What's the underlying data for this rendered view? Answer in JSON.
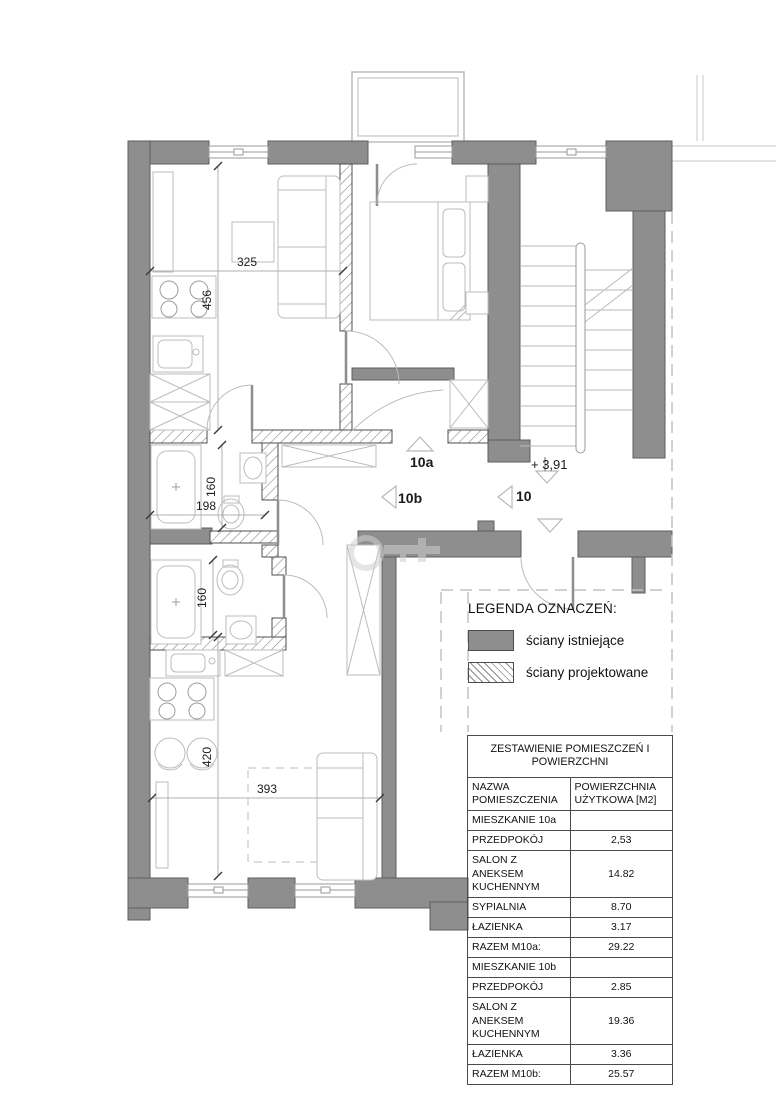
{
  "plan": {
    "dims": {
      "salon_10a_width": "325",
      "salon_10a_height": "456",
      "bath_10a_width": "198",
      "bath_10a_height": "160",
      "bath_10b_height": "160",
      "salon_10b_height": "420",
      "salon_10b_width": "393"
    },
    "markers": {
      "apt_10a": "10a",
      "apt_10b": "10b",
      "entrance_10": "10",
      "level": "+ 3,91"
    }
  },
  "legend": {
    "title": "LEGENDA OZNACZEŃ:",
    "items": [
      {
        "label": "ściany istniejące",
        "swatch": "solid"
      },
      {
        "label": "ściany projektowane",
        "swatch": "hatched"
      }
    ]
  },
  "table": {
    "title": "ZESTAWIENIE POMIESZCZEŃ I POWIERZCHNI",
    "columns": [
      "NAZWA POMIESZCZENIA",
      "POWIERZCHNIA UŻYTKOWA [M2]"
    ],
    "rows": [
      {
        "name": "MIESZKANIE 10a",
        "area": ""
      },
      {
        "name": "PRZEDPOKÓJ",
        "area": "2,53"
      },
      {
        "name": "SALON Z ANEKSEM KUCHENNYM",
        "area": "14.82"
      },
      {
        "name": "SYPIALNIA",
        "area": "8.70"
      },
      {
        "name": "ŁAZIENKA",
        "area": "3.17"
      },
      {
        "name": "RAZEM M10a:",
        "area": "29.22"
      },
      {
        "name": "MIESZKANIE 10b",
        "area": ""
      },
      {
        "name": "PRZEDPOKÓJ",
        "area": "2.85"
      },
      {
        "name": "SALON Z ANEKSEM KUCHENNYM",
        "area": "19.36"
      },
      {
        "name": "ŁAZIENKA",
        "area": "3.36"
      },
      {
        "name": "RAZEM M10b:",
        "area": "25.57"
      }
    ]
  },
  "colors": {
    "wall_existing": "#8e8e8e",
    "wall_outline": "#5e5e5e",
    "line_light": "#bcbcbc",
    "text": "#1a1a1a"
  }
}
